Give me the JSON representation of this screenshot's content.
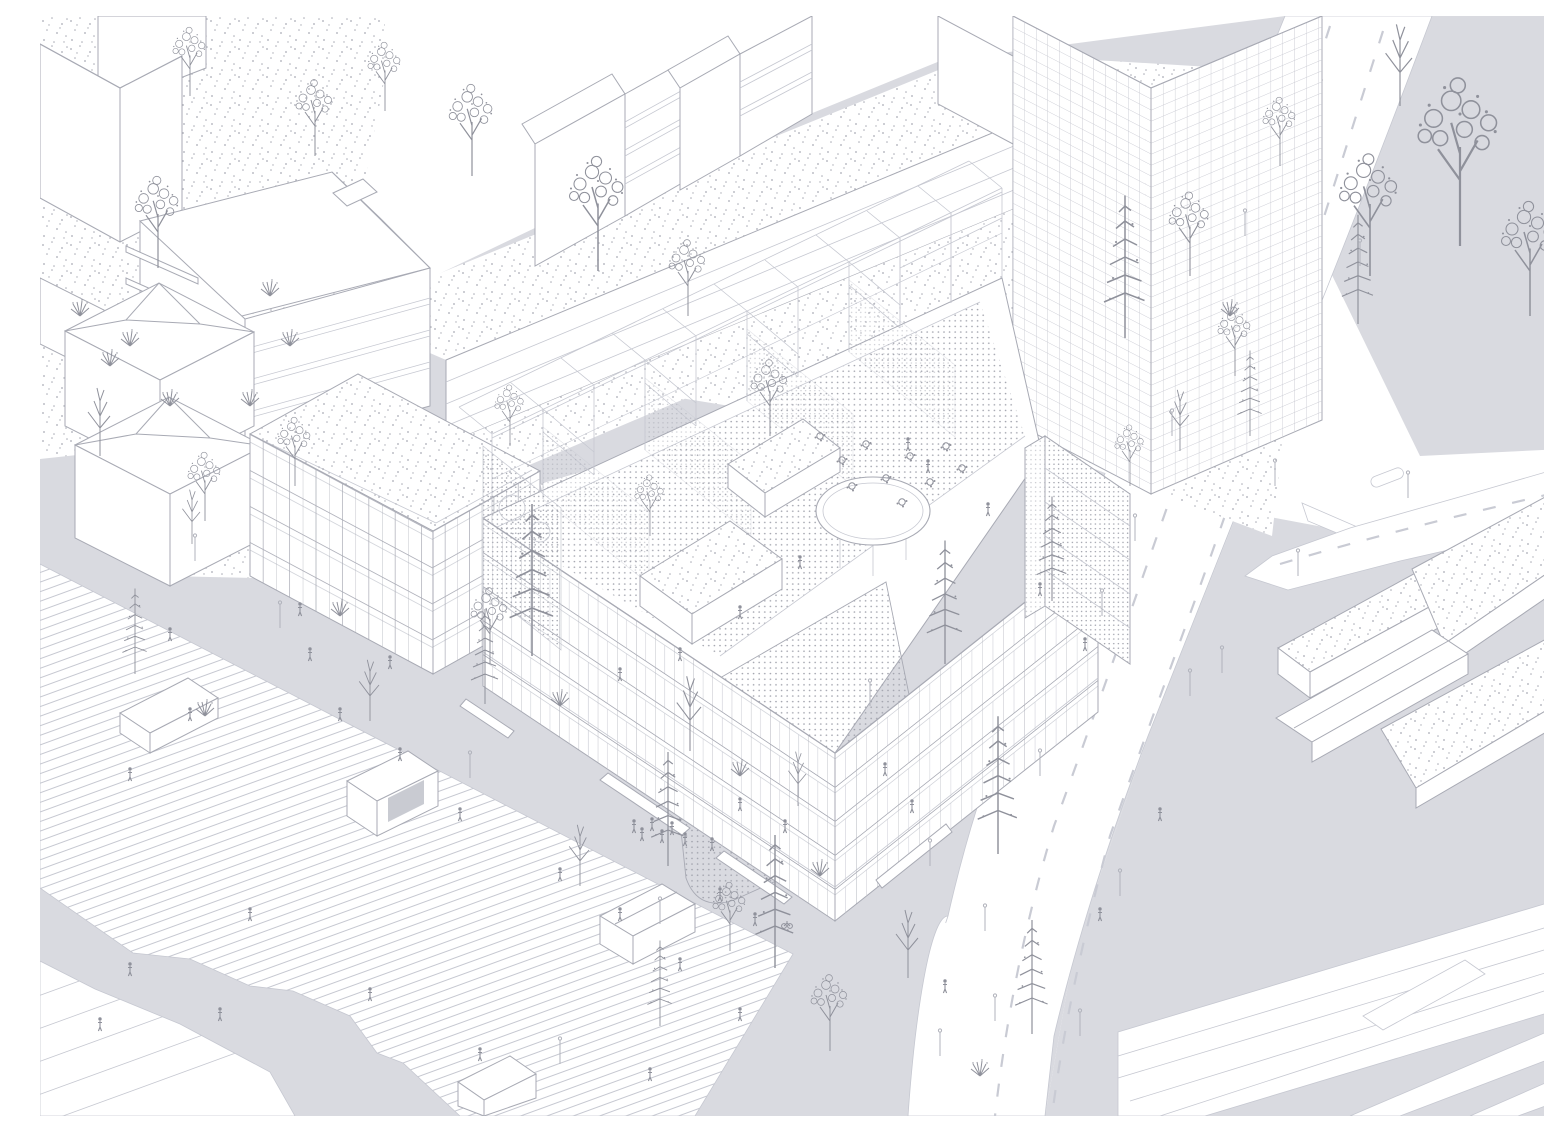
{
  "figure": {
    "title": "Axonometric urban site illustration",
    "description": "Monochrome bird's-eye axonometric line drawing: a wedge-shaped mid-rise building with an open rooftop steel frame, perforated mesh screens, roof terraces, gravel-topped stair boxes and an oval canopy; surrounded by a striped pedestrian plaza with pavilions and trees, gray sidewalks with pedestrians and lampposts, a curving multi-lane road with dashed markings and traffic islands, neighboring housing slabs, a gridded glass tower, planted low buildings and a railway corridor with platform."
  },
  "palette": {
    "background": "#ffffff",
    "ground_gray": "#d9dae0",
    "line_light": "#c6c8d1",
    "line_mid": "#a8aab4",
    "line_dark": "#8f919b",
    "stipple_dot": "#a9abb4",
    "mesh_dot": "#9fa1ab",
    "road_dash": "#c9cbd4"
  },
  "scene": {
    "areas": [
      {
        "name": "striped-plaza",
        "surface": "white paving with fine diagonal stripes"
      },
      {
        "name": "stepped-terrace",
        "surface": "white terraced steps at lower left"
      },
      {
        "name": "sidewalks",
        "surface": "flat light gray ground"
      },
      {
        "name": "main-road",
        "surface": "white carriageway, dashed lane lines, traffic islands"
      },
      {
        "name": "branch-road",
        "surface": "white road forking to the right edge"
      },
      {
        "name": "railway-corridor",
        "surface": "white band with parallel tracks and platform"
      },
      {
        "name": "roof-gardens",
        "surface": "white ground with random stipple planting dots"
      }
    ],
    "buildings": [
      {
        "name": "main-building",
        "features": "wedge plan, gridded facades, rooftop steel gantry frame, mesh screen walls with porthole rings, dotted roof decks, two gravel-roof stair boxes, oval canopy, roof terrace with tables"
      },
      {
        "name": "left-window-block",
        "features": "six-story block, window grid, gravel stipple roof"
      },
      {
        "name": "parking-deck",
        "features": "long deck with banded edge and planted stipple roof"
      },
      {
        "name": "balcony-slab",
        "features": "housing slab with projecting balcony bands and hipped roof"
      },
      {
        "name": "gabled-slabs",
        "features": "two pitched-roof housing slabs at top center"
      },
      {
        "name": "corner-towers",
        "features": "plain white volumes at top left"
      },
      {
        "name": "hip-roof-houses",
        "features": "two cubic houses with hipped roofs"
      },
      {
        "name": "grid-tower",
        "features": "tall curtain-wall tower with fine grid, top right"
      },
      {
        "name": "planted-bars",
        "features": "low bars with gravel stipple roofs, bottom right"
      },
      {
        "name": "plaza-pavilions",
        "features": "small white gabled and flat kiosks on the plaza"
      }
    ],
    "landscape": {
      "trees": [
        "sparse conifers",
        "round bubble-canopy trees",
        "bare branching saplings",
        "shrub tufts"
      ],
      "figures": "tiny pedestrians, roof visitors and a cyclist",
      "street_furniture": "lampposts along roads and plaza"
    }
  }
}
